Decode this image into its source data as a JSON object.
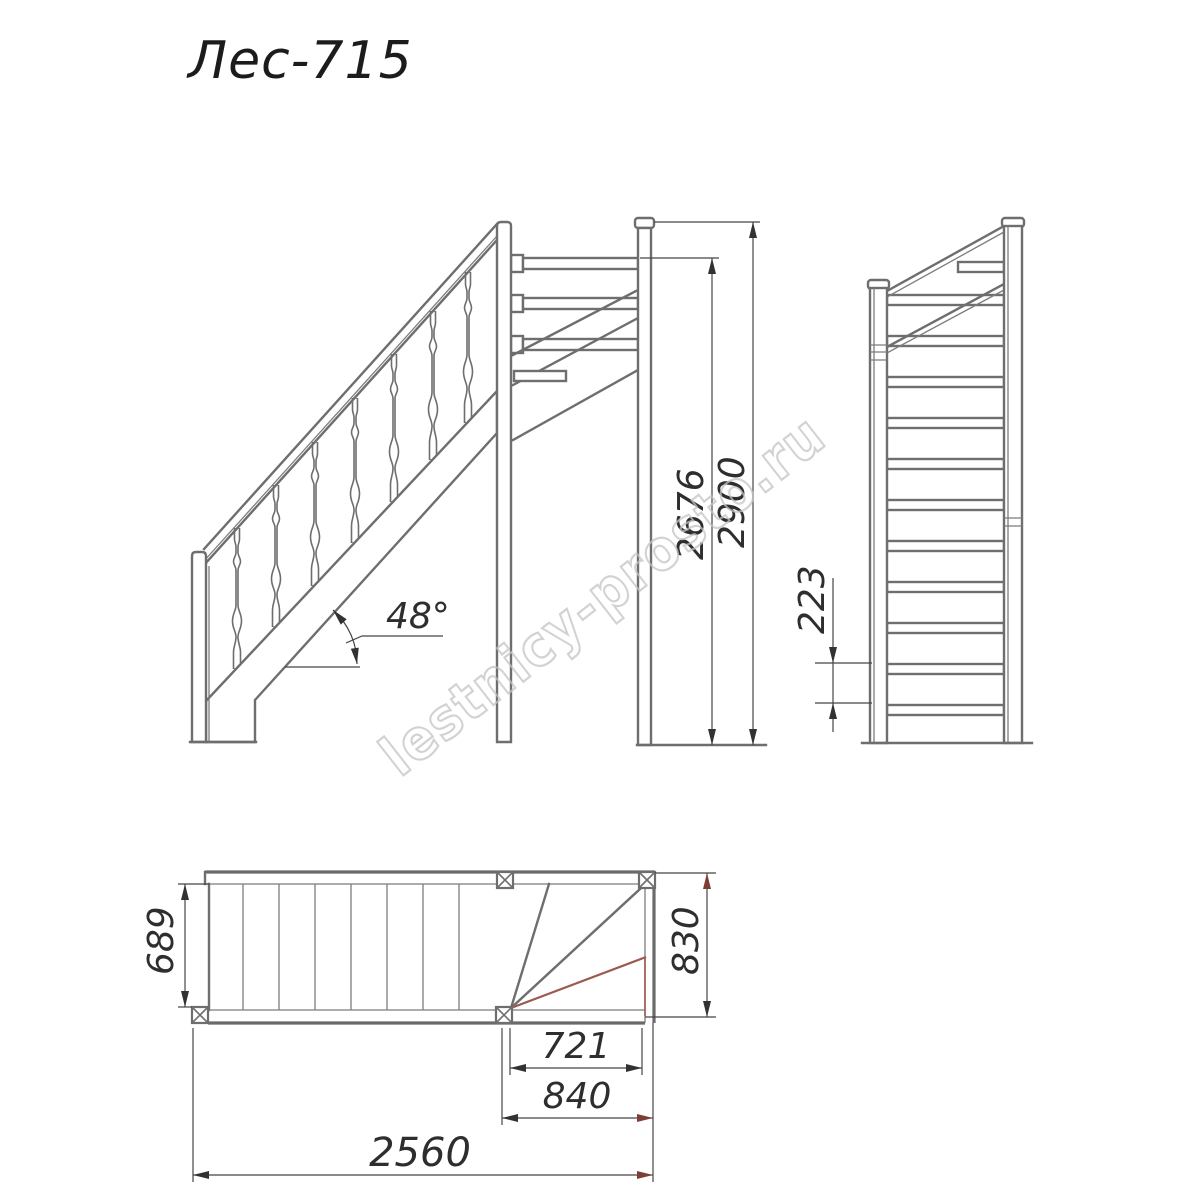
{
  "title": "Лес-715",
  "watermark": "lestnicy-prosto.ru",
  "views": {
    "side": {
      "label": "side-elevation",
      "height_total": "2900",
      "height_to_rail": "2676",
      "angle_label": "48°"
    },
    "front": {
      "label": "front-elevation",
      "riser_height": "223"
    },
    "plan": {
      "label": "plan-view",
      "flight_width": "689",
      "upper_flight_width": "830",
      "winder_inner_depth": "721",
      "winder_outer_depth": "840",
      "total_length": "2560"
    }
  }
}
